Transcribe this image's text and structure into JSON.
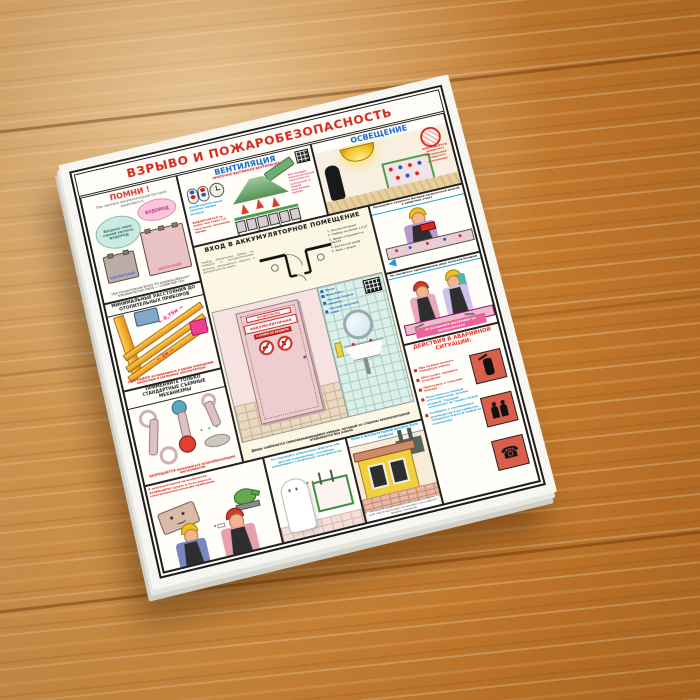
{
  "colors": {
    "title_red": "#d42b20",
    "section_blue": "#1767c4",
    "ban_red": "#e03028",
    "emergency_tile": "#d95f4a",
    "pink_accent": "#e8639a",
    "wood_base": "#d98f3b"
  },
  "icons": {
    "phone": "☎",
    "sparks": "✦ ✦ ✦",
    "sparks_small": "✦ ✦"
  },
  "poster": {
    "title": "ВЗРЫВО И ПОЖАРОБЕЗОПАСНОСТЬ",
    "pomni": {
      "header": "ПОМНИ !",
      "caption": "При зарядке аккумуляторной батареи выделяются",
      "cloud_left": "Вредные пары серной кислоты ВОДОРОД",
      "cloud_right": "ВОДОРОД",
      "battery_left": "КИСЛОТНЫЙ",
      "battery_right": "ЩЕЛОЧНОЙ",
      "note": "При концентрации более 3% водород образует взрывоопасную смесь — «гремучий газ»"
    },
    "ventilation": {
      "header": "ВЕНТИЛЯЦИЯ",
      "subtitle": "ПРИТОЧНО-ВЫТЯЖНАЯ ВЕНТИЛЯЦИЯ",
      "on_text": "ВКЛЮЧАЕТСЯ перед началом заряда батареи",
      "off_text": "ВЫКЛЮЧАЕТСЯ не ранее чем через 1,5 часа после окончания заряда",
      "note": "Вентиляция аккумуляторной выполняется отдельной от общей вентиляции здания"
    },
    "lighting": {
      "header": "ОСВЕЩЕНИЕ",
      "ban": "ЗАПРЕЩАЕТСЯ применять светильники открытого исполнения"
    },
    "entrance": {
      "header": "ВХОД В АККУМУЛЯТОРНОЕ ПОМЕЩЕНИЕ",
      "text": "Тамбур обязателен. Дверь из тамбура в аккумуляторную должна открываться наружу и запираться на замок.",
      "legend": [
        "1. Аккумуляторная",
        "2. Тамбур не менее 1,5 м²",
        "3. Двери открываются наружу",
        "4. Вытяжной шкаф",
        "5. Кран с водой"
      ],
      "door_sign_top": "ОГНЕОПАСНО",
      "door_sign_main": "АККУМУЛЯТОРНАЯ",
      "door_sign_small": "С ОГНЁМ НЕ ВХОДИТЬ",
      "supplies": [
        "Мыло",
        "Вата 100 г",
        "Раствор борной кислоты",
        "Раствор питьевой соды"
      ],
      "caption": "Дверь снабжается самозакрывающимся замком, который со стороны аккумуляторной открывается без ключа"
    },
    "distances": {
      "header": "МИНИМАЛЬНЫЕ РАССТОЯНИЯ ДО ОТОПИТЕЛЬНЫХ ПРИБОРОВ",
      "d1": "← 0,75м →",
      "d2": "← 1м →",
      "ban": "ЗАПРЕЩЕНО устанавливать в одном помещении кислотные и щелочные аккумуляторы"
    },
    "tools": {
      "header": "ПРИМЕНЯЙТЕ ТОЛЬКО СТАНДАРТНЫЕ СЪЕМНЫЕ МЕХАНИЗМЫ",
      "ban": "ЗАПРЕЩАЕТСЯ пользоваться искрообразующим инструментом"
    },
    "worker1": {
      "caption": "Проверяйте элементы батареи нагрузочной вилкой в защитных очках"
    },
    "worker2": {
      "caption": "Не касайтесь одновременно двух полюсов батареи",
      "label": "НЕ ОСТАВЛЯЙТЕ ИНСТРУМЕНТ НА АККУМУЛЯТОРАХ"
    },
    "emergency": {
      "header": "ДЕЙСТВИЯ В АВАРИЙНОЙ СИТУАЦИИ:",
      "items": [
        {
          "text": "При пожаре вызвать пожарную охрану"
        },
        {
          "text": "Обесточить зарядное устройство"
        },
        {
          "text": "Приступить к тушению пожара"
        },
        {
          "text": "Пользоваться пенным огнетушителем, песком, кошмой. Горящий электролит не тушить водой"
        },
        {
          "text": "Сообщить о случившемся руководству и до прибытия пожарных вывести людей из помещения"
        }
      ]
    },
    "smoking": {
      "caption": "В аккумуляторной категорически ЗАПРЕЩЕНО курить и пользоваться электронагревательными приборами"
    },
    "apron": {
      "caption": "Не надевайте капроновые фартуки или другую спецодежду, способную накапливать статическое электричество"
    },
    "windows": {
      "header": "Окна в аккумуляторной должны быть закрыты",
      "note": "Летом для проветривания окна можно открыть, если наружный воздух не запылён и не содержит вредных примесей"
    }
  }
}
